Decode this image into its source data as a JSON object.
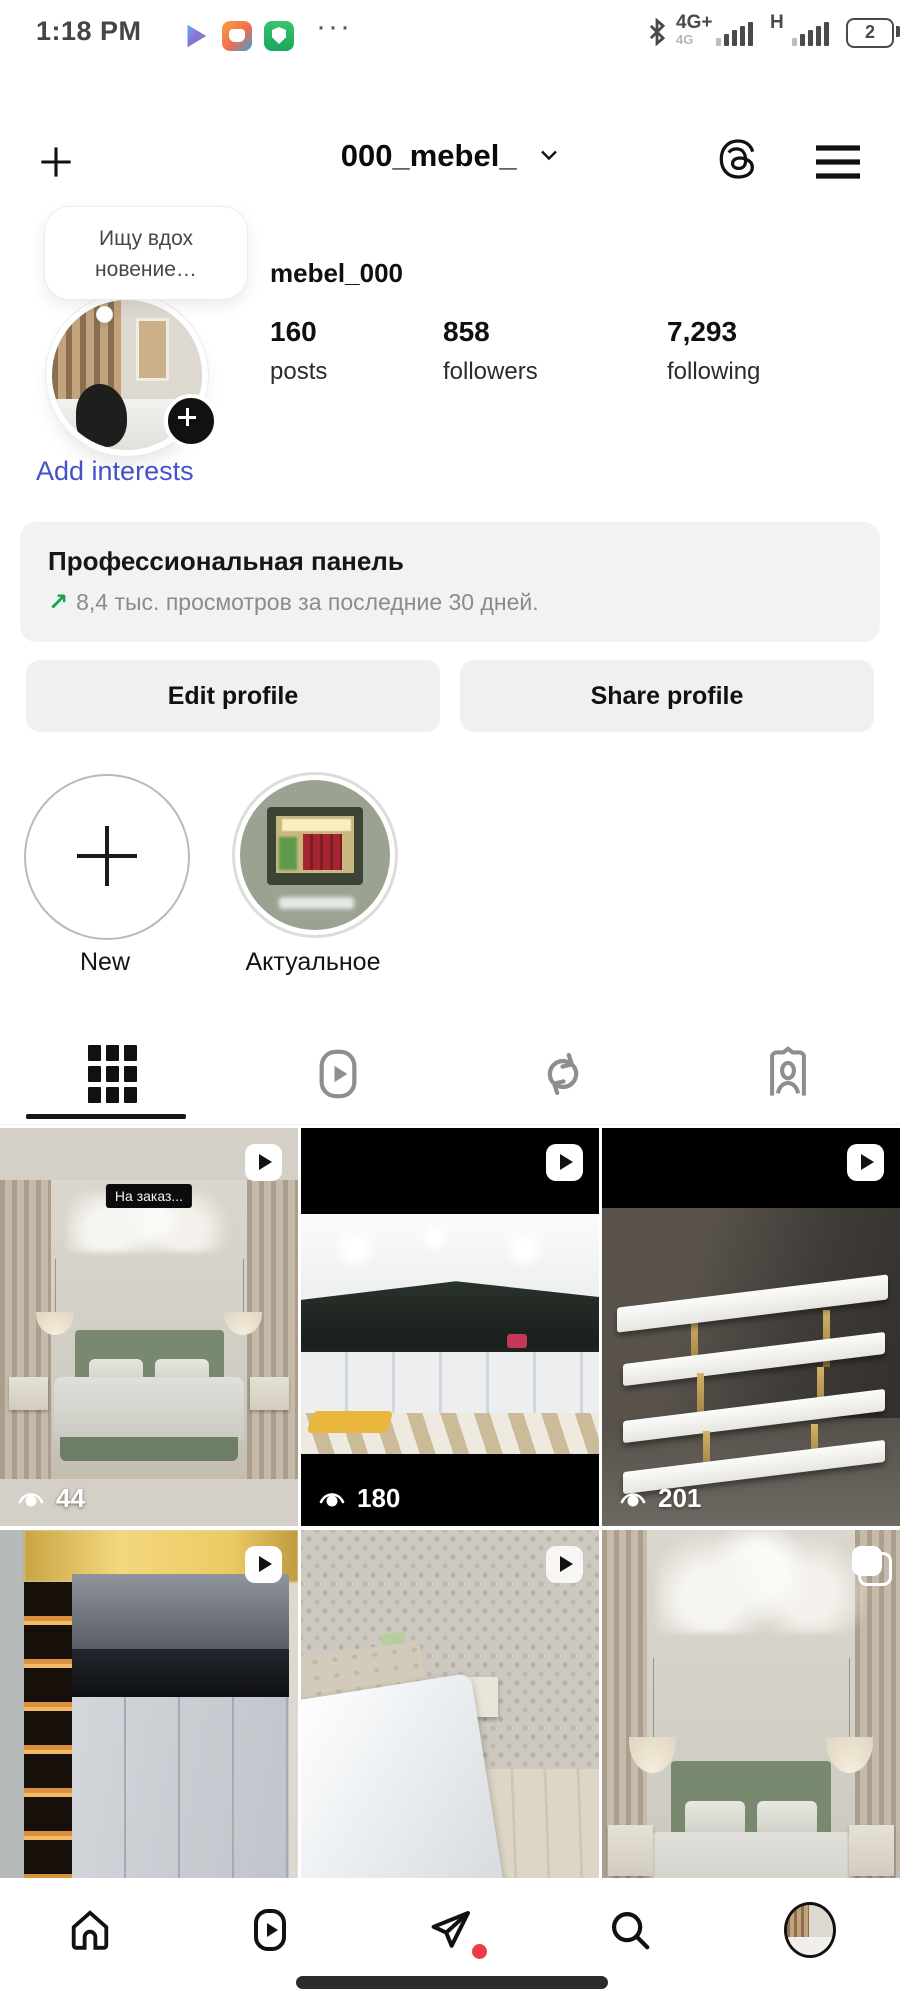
{
  "status_bar": {
    "time": "1:18 PM",
    "more_icon": "···",
    "network_primary": "4G+",
    "network_primary_sub": "4G",
    "network_secondary": "H",
    "battery_level": "2"
  },
  "header": {
    "title": "000_mebel_"
  },
  "profile": {
    "note_bubble": {
      "line1": "Ищу вдох",
      "line2": "новение…"
    },
    "username": "mebel_000",
    "stats": [
      {
        "value": "160",
        "label": "posts"
      },
      {
        "value": "858",
        "label": "followers"
      },
      {
        "value": "7,293",
        "label": "following"
      }
    ],
    "add_interests_label": "Add interests"
  },
  "professional_panel": {
    "title": "Профессиональная панель",
    "trend_arrow": "↗",
    "subtitle": "8,4 тыс. просмотров за последние 30 дней."
  },
  "action_buttons": {
    "edit": "Edit profile",
    "share": "Share profile"
  },
  "highlights": [
    {
      "label": "New"
    },
    {
      "label": "Актуальное"
    }
  ],
  "content_tabs": [
    {
      "icon": "grid-icon",
      "active": true
    },
    {
      "icon": "reels-icon",
      "active": false
    },
    {
      "icon": "repost-icon",
      "active": false
    },
    {
      "icon": "tagged-icon",
      "active": false
    }
  ],
  "grid": {
    "posts": [
      {
        "views": "44",
        "caption": "На заказ...",
        "badge": "video"
      },
      {
        "views": "180",
        "badge": "video"
      },
      {
        "views": "201",
        "badge": "video"
      },
      {
        "badge": "video"
      },
      {
        "badge": "video"
      },
      {
        "badge": "carousel"
      }
    ]
  },
  "bottom_nav": [
    "home-icon",
    "reels-icon",
    "share-icon",
    "search-icon",
    "profile-avatar"
  ],
  "colors": {
    "link_blue": "#4652c9",
    "trend_green": "#17a24b",
    "notification_red": "#ee3b48"
  }
}
